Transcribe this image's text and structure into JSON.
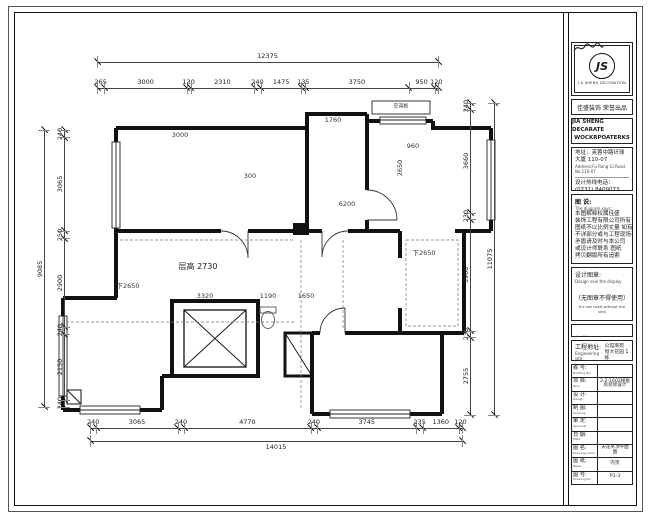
{
  "sheet": {
    "bg": "#ffffff",
    "line_color": "#1a1a1a"
  },
  "plan": {
    "dims_top": {
      "total": "12375",
      "segments": [
        "265",
        "3000",
        "130",
        "2310",
        "240",
        "1475",
        "135",
        "3750",
        "950",
        "120"
      ]
    },
    "dims_bottom": {
      "total": "14015",
      "segments": [
        "240",
        "3065",
        "240",
        "4770",
        "240",
        "3745",
        "235",
        "1360",
        "120"
      ]
    },
    "dims_left": {
      "total": "9085",
      "segments": [
        "240",
        "3065",
        "250",
        "2900",
        "240",
        "2150",
        "240"
      ]
    },
    "dims_right": {
      "total": "11075",
      "segments": [
        "240",
        "3660",
        "230",
        "3960",
        "230",
        "2755"
      ]
    },
    "inner_dims": [
      "3000",
      "1760",
      "960",
      "2650",
      "6200",
      "3320",
      "1190",
      "1650",
      "300"
    ],
    "labels": {
      "ceiling": "层高 2730",
      "drop_left": "下2650",
      "drop_right": "下2650",
      "ac_panel": "空调板"
    }
  },
  "title_block": {
    "logo": {
      "initials": "JS",
      "caption": "J A SHENG DECORATION"
    },
    "brand_cn": "佳盛装饰 荣誉出品",
    "brand_en_1": "JIA SHENG DECARATE",
    "brand_en_2": "WOCKRPOATERKS",
    "address_cn": "地址：芙蓉中路环球大厦 110-07",
    "address_en": "Address:Fu Rong Gi Road No.110-07",
    "phone_cn": "设计热线电话： (0731) 8409073",
    "phone_en": "Telephone:",
    "notes_title_cn": "图 说:",
    "notes_title_en": "The diagram says:",
    "notes_lines": [
      "本图解释权属佳盛",
      "装饰工程有限公司所有",
      "图纸不以比例丈量 如有",
      "不详部分或与工程现场有",
      "矛盾请及时与本公司",
      "或设计师联系 图纸",
      "拷贝翻版所有追索"
    ],
    "stamp_label_cn": "设计图章:",
    "stamp_label_en": "Design seal the display",
    "stamp_warning_cn": "（无图章不得使用）",
    "stamp_warning_en": "It's not used without the seal",
    "remark_cn": "备 注:",
    "remark_en": "Note:",
    "site_label_cn": "工程地址:",
    "site_label_en": "Engineering site",
    "site_value_1": "公馆南苑",
    "site_value_2": "恒大花园 1栋",
    "rows": [
      {
        "label": "栋 号:",
        "sub": "Building No.",
        "value": ""
      },
      {
        "label": "项 目:",
        "sub": "Item",
        "value": "2-2-1602样板房装修设计"
      },
      {
        "label": "设 计:",
        "sub": "Design",
        "value": "",
        "signature": true
      },
      {
        "label": "制 图:",
        "sub": "Drawing",
        "value": ""
      },
      {
        "label": "审 定:",
        "sub": "Approval",
        "value": ""
      },
      {
        "label": "日 期:",
        "sub": "Date",
        "value": ""
      },
      {
        "label": "图 名:",
        "sub": "Drawing name",
        "value": "天花吊顶平面图"
      },
      {
        "label": "图 纸:",
        "sub": "Paper",
        "value": "内页"
      },
      {
        "label": "图 号:",
        "sub": "Drawing No.",
        "value": "P1-3"
      }
    ]
  }
}
